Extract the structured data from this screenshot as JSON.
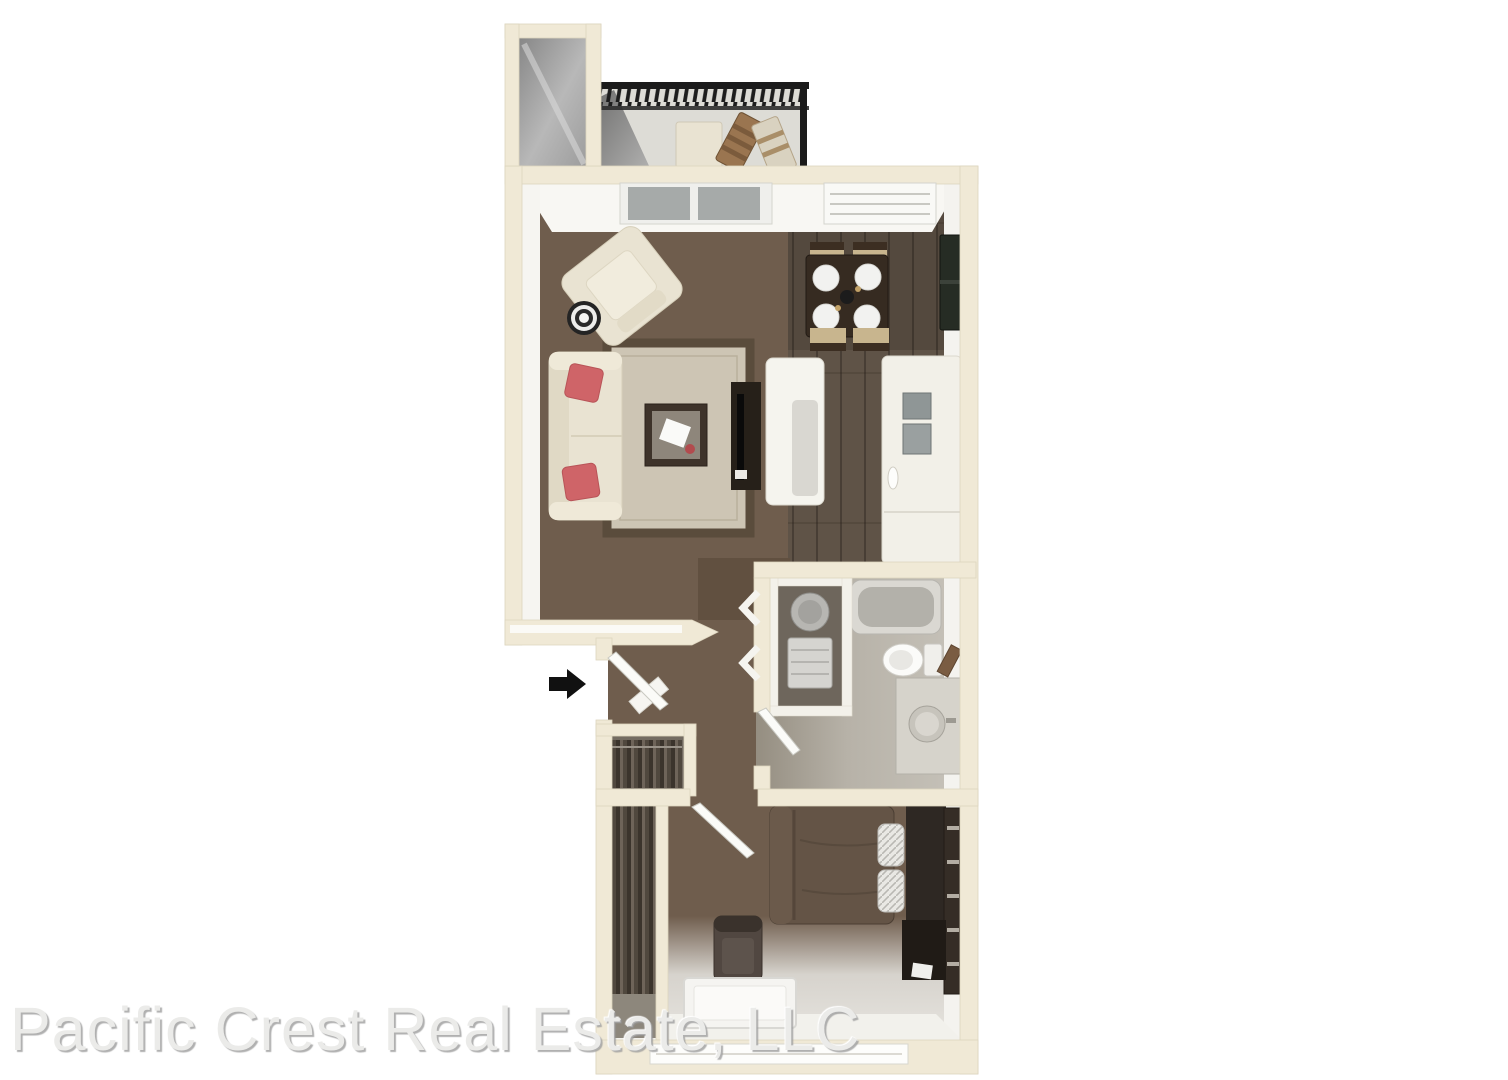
{
  "image": {
    "kind": "3d-floor-plan-rendering",
    "view": "top-down dollhouse view of a one-bedroom, one-bath apartment with balcony"
  },
  "watermark": {
    "text": "Pacific Crest Real Estate, LLC"
  },
  "entry": {
    "icon": "entry-arrow-icon",
    "direction": "right"
  },
  "palette": {
    "background": "#ffffff",
    "wall": "#f0e9d6",
    "wall_edge": "#ddd5bf",
    "wall_face": "#f8f7f3",
    "carpet": "#6f5d4d",
    "carpet_dark": "#615040",
    "wood_floor": "#5f5347",
    "tile_floor": "#b7b2a8",
    "balcony_floor": "#dddcd6",
    "rug": "#cdc5b4",
    "rug_border": "#5a4c3c",
    "sofa": "#e9e3d2",
    "pillow": "#cf6468",
    "wood_chair": "#9a7550",
    "chair_tan": "#c8b58e",
    "dark_furniture": "#2b241e",
    "bed": "#645446",
    "railing": "#1b1b1b",
    "fixture_white": "#f5f4ee",
    "fixture_gray": "#c0beb7",
    "watermark": "#ebebe9"
  }
}
